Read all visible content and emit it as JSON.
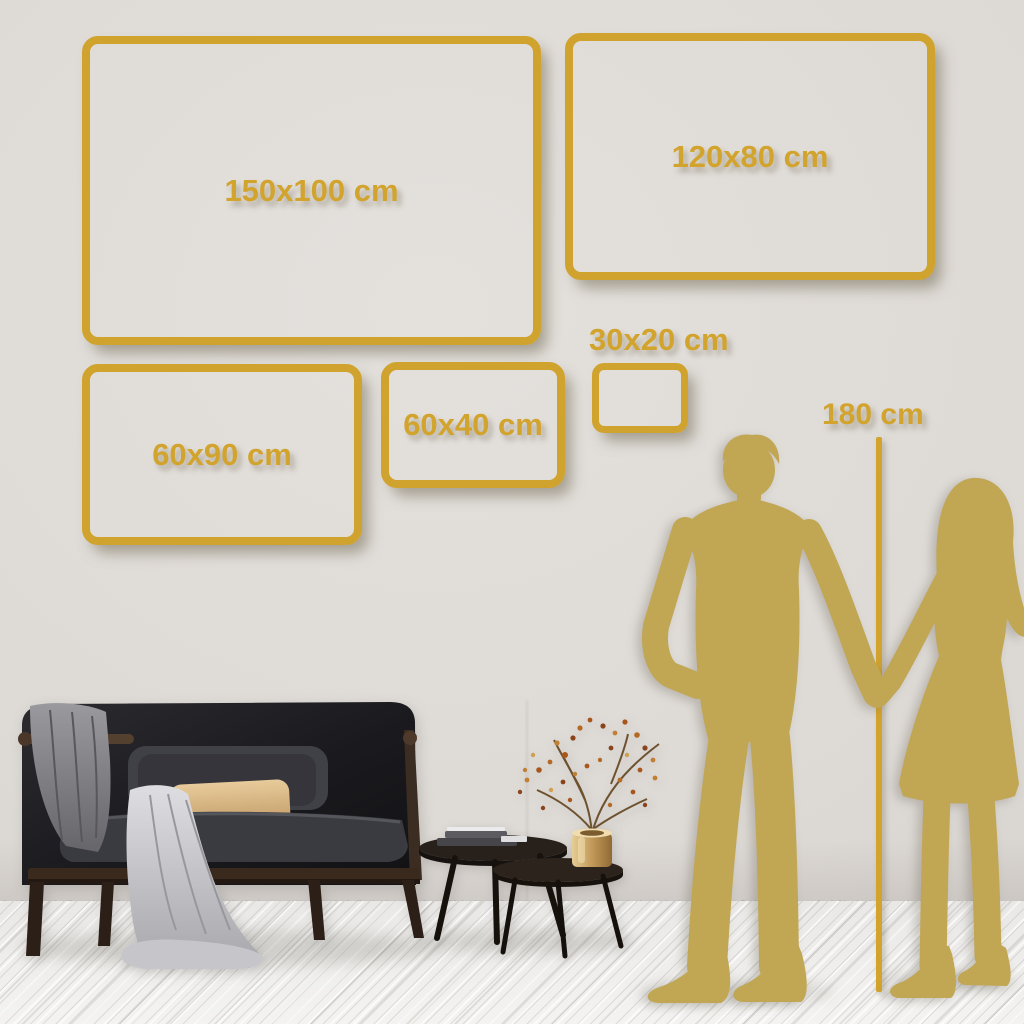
{
  "sizes": [
    {
      "label": "150x100 cm",
      "width_cm": 150,
      "height_cm": 100
    },
    {
      "label": "120x80 cm",
      "width_cm": 120,
      "height_cm": 80
    },
    {
      "label": "60x90 cm",
      "width_cm": 60,
      "height_cm": 90
    },
    {
      "label": "60x40 cm",
      "width_cm": 60,
      "height_cm": 40
    },
    {
      "label": "30x20 cm",
      "width_cm": 30,
      "height_cm": 20
    }
  ],
  "height_marker": {
    "label": "180 cm",
    "height_cm": 180
  },
  "colors": {
    "accent_gold": "#d2a42e",
    "silhouette_gold": "#c1a654",
    "wall": "#dedad6",
    "floor": "#f0efed",
    "sofa_dark": "#1b1b1e",
    "pillow_tan": "#d7b88a",
    "blanket_gray": "#cfcfd3",
    "vase_gold": "#c9a35c",
    "blossom_rust": "#b5651d"
  },
  "decor": {
    "silhouettes": [
      "man-silhouette",
      "woman-silhouette"
    ],
    "furniture": [
      "sofa",
      "nesting-coffee-tables",
      "books",
      "vase-with-dried-branch"
    ]
  }
}
